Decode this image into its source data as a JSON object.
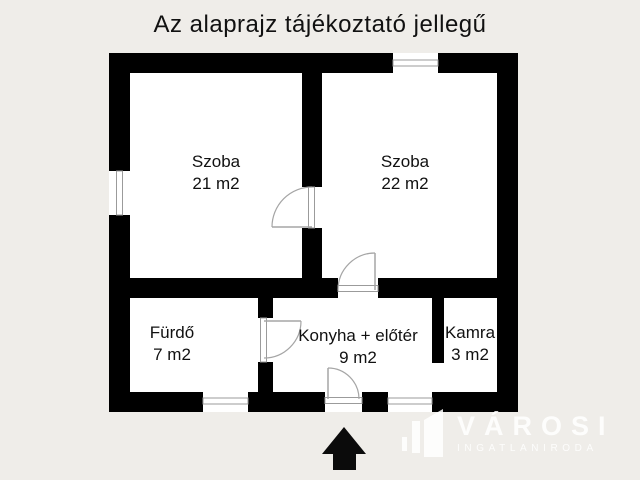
{
  "title": "Az alaprajz tájékoztató jellegű",
  "rooms": [
    {
      "id": "szoba-1",
      "name": "Szoba",
      "area": "21 m2"
    },
    {
      "id": "szoba-2",
      "name": "Szoba",
      "area": "22 m2"
    },
    {
      "id": "furdo",
      "name": "Fürdő",
      "area": "7 m2"
    },
    {
      "id": "konyha-eloter",
      "name": "Konyha + előtér",
      "area": "9 m2"
    },
    {
      "id": "kamra",
      "name": "Kamra",
      "area": "3 m2"
    }
  ],
  "watermark": {
    "brand": "VÁROSI",
    "subtitle": "INGATLANIRODA"
  },
  "icons": {
    "entrance_arrow": "up-arrow-icon",
    "logo": "buildings-icon"
  },
  "colors": {
    "background": "#efede9",
    "wall": "#000000",
    "room_fill": "#ffffff",
    "opening_line": "#9b9b9b",
    "text": "#111111",
    "watermark_text": "#ffffff"
  }
}
